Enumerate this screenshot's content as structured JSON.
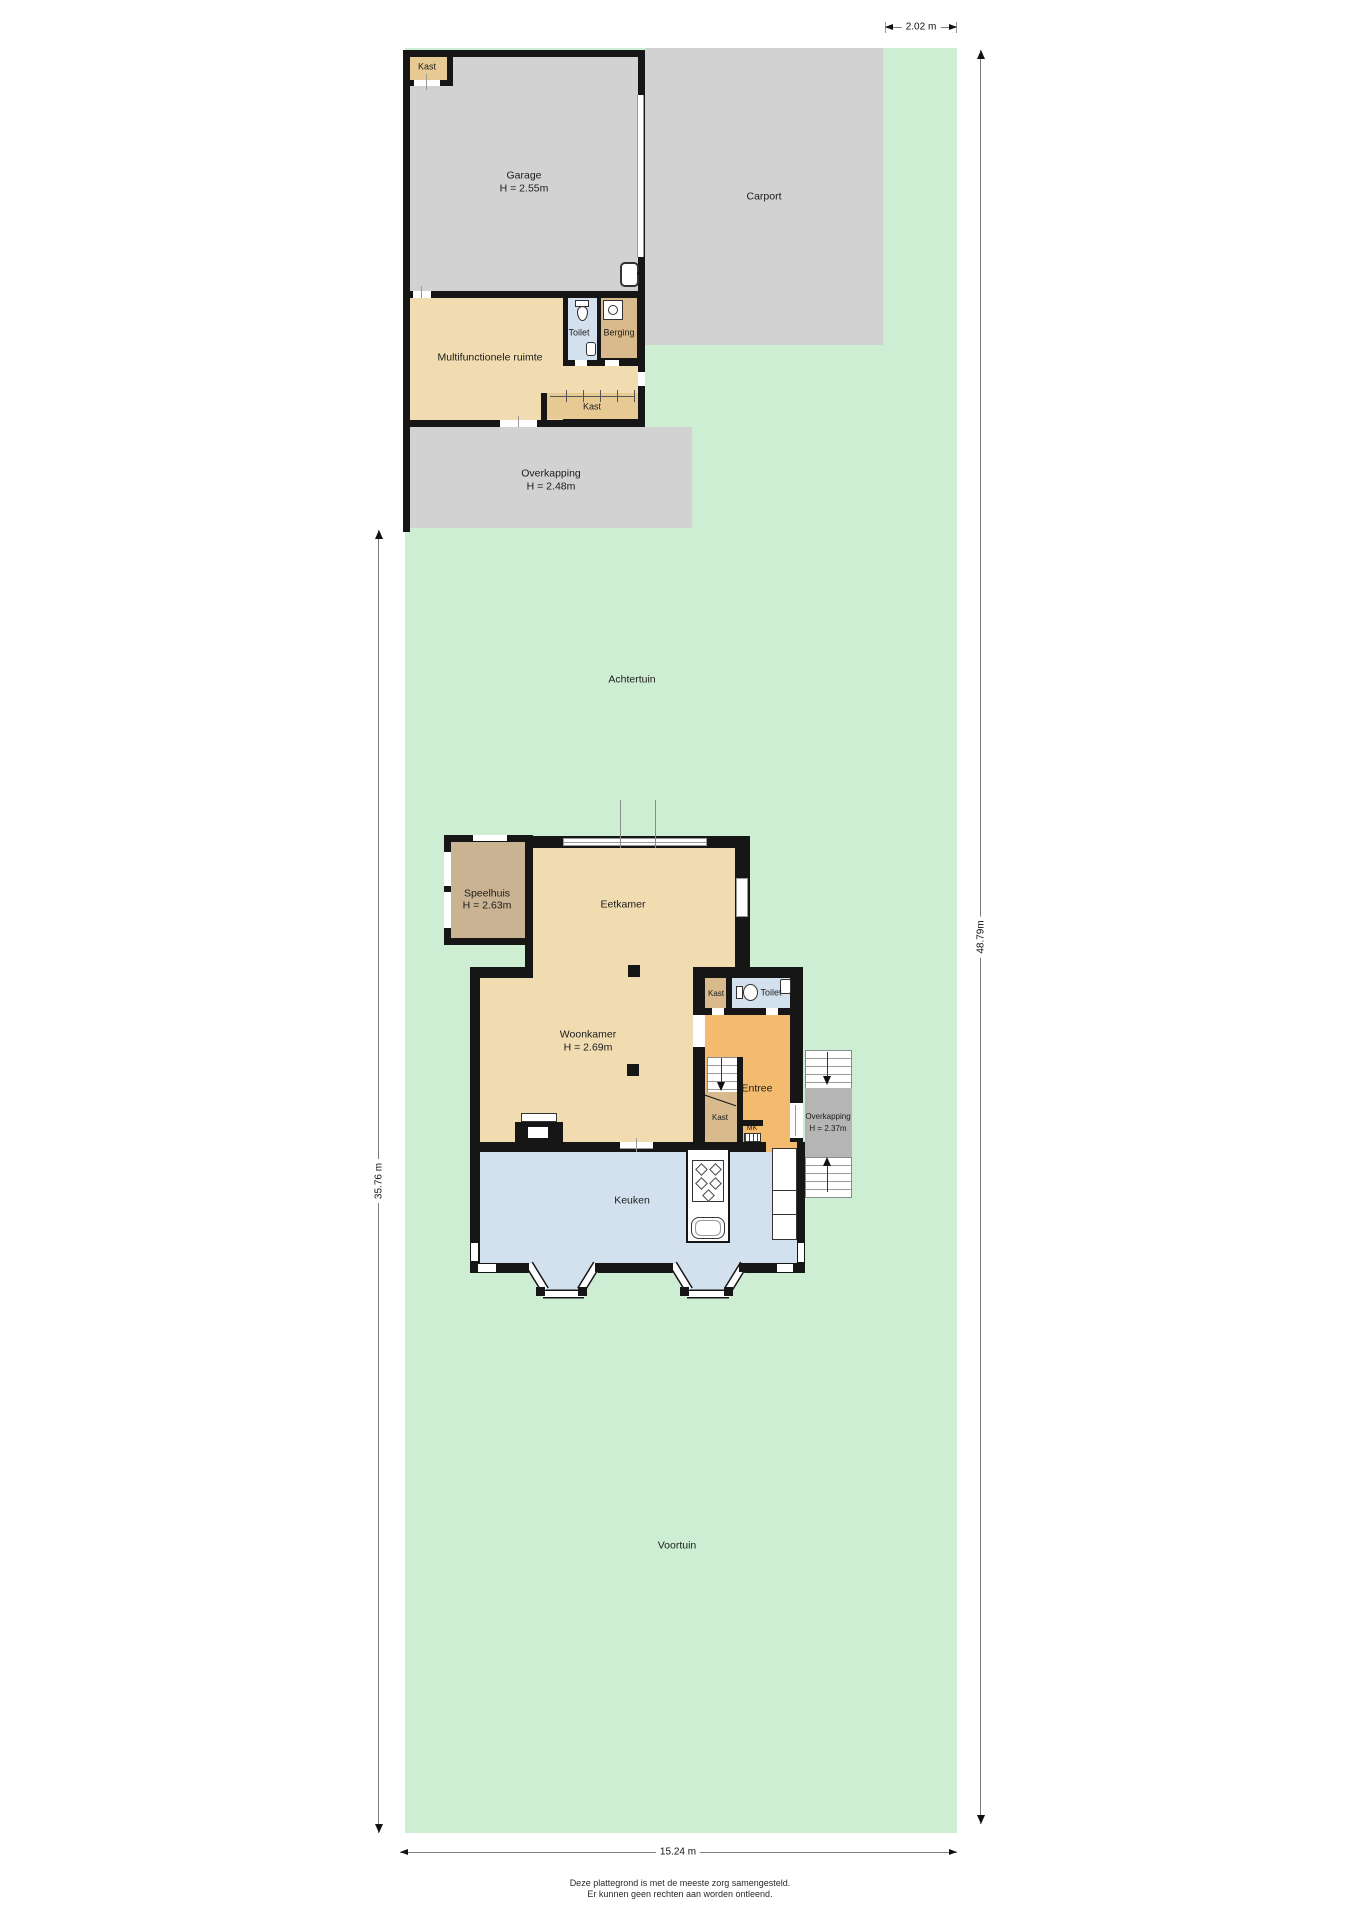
{
  "garden": {
    "back_label": "Achtertuin",
    "front_label": "Voortuin"
  },
  "dimensions": {
    "top": "2.02 m",
    "right": "48.79m",
    "left": "35.76 m",
    "bottom": "15.24 m"
  },
  "outbuilding": {
    "kast_label": "Kast",
    "garage_label": "Garage",
    "garage_height": "H = 2.55m",
    "carport_label": "Carport",
    "multifunctional_label": "Multifunctionele ruimte",
    "toilet_label": "Toilet",
    "berging_label": "Berging",
    "kast_strip_label": "Kast",
    "overkapping_label": "Overkapping",
    "overkapping_height": "H = 2.48m"
  },
  "house": {
    "speelhuis_label": "Speelhuis",
    "speelhuis_height": "H = 2.63m",
    "eetkamer_label": "Eetkamer",
    "woonkamer_label": "Woonkamer",
    "woonkamer_height": "H = 2.69m",
    "kast_label": "Kast",
    "toilet_label": "Toilet",
    "entree_label": "Entree",
    "kast_stairs_label": "Kast",
    "mk_label": "MK",
    "overkapping_label": "Overkapping",
    "overkapping_height": "H = 2.37m",
    "keuken_label": "Keuken"
  },
  "footer": {
    "line1": "Deze plattegrond is met de meeste zorg samengesteld.",
    "line2": "Er kunnen geen rechten aan worden ontleend."
  },
  "colors": {
    "wall": "#161616",
    "garden": "#cdeed3",
    "paving": "#d2d2d2",
    "tan": "#f0dcb0",
    "kast": "#e7c993",
    "brown": "#d8ba8c",
    "speelhuis": "#c9b392",
    "blue": "#d3e1ee",
    "orange": "#f4bb6e",
    "canopy": "#b5b5b5"
  }
}
